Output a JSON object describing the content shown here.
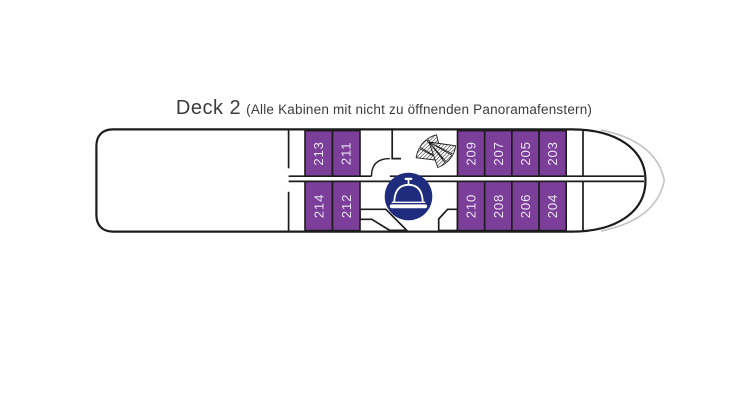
{
  "title": {
    "deck_label": "Deck 2",
    "subtitle": "(Alle Kabinen mit nicht zu öffnenden Panoramafenstern)"
  },
  "plan": {
    "cabins": {
      "top": [
        "213",
        "211",
        "209",
        "207",
        "205",
        "203"
      ],
      "bottom": [
        "214",
        "212",
        "210",
        "208",
        "206",
        "204"
      ]
    },
    "icons": {
      "stairs": "stairs-icon",
      "restaurant": "restaurant-icon"
    },
    "colors": {
      "cabin_fill": "#7B3E99",
      "cabin_number_text": "#EDE4F4",
      "hull_outline": "#1C1C1C",
      "restaurant_badge": "#1F2B7C",
      "bow_accent_line": "#C6C6C6",
      "title_text": "#3C3C3C"
    }
  }
}
